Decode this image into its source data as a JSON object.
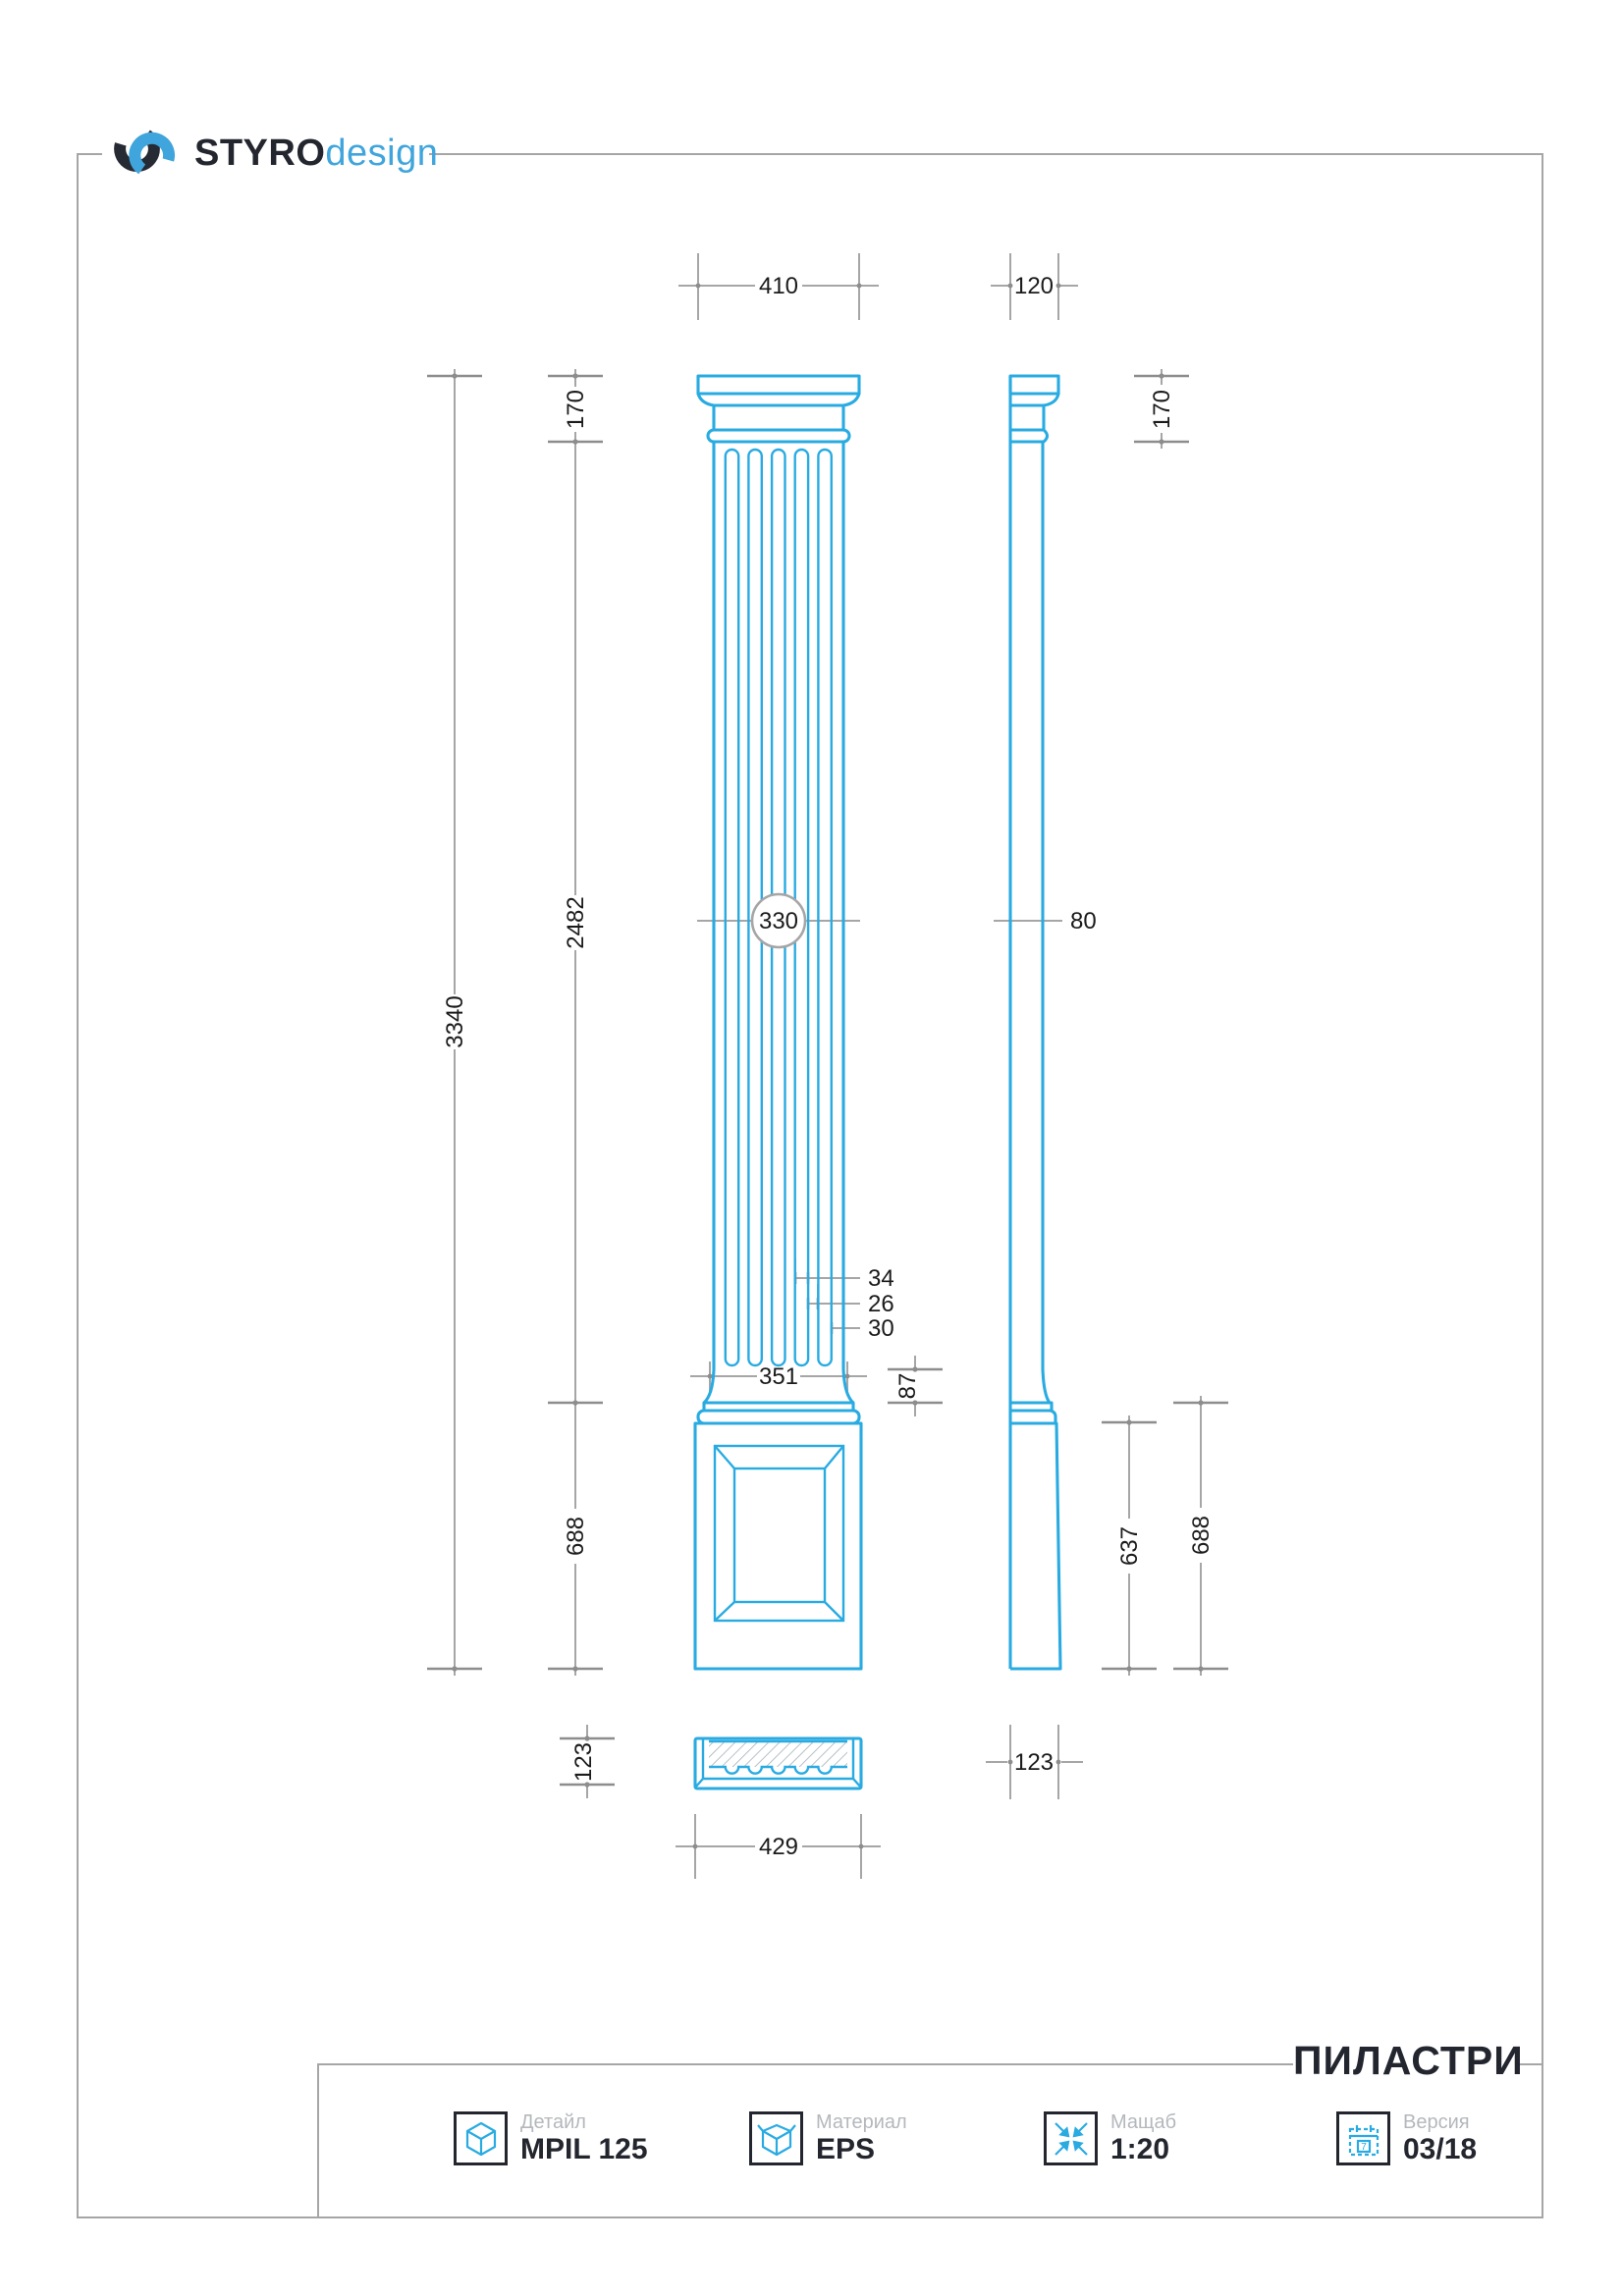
{
  "logo": {
    "brand_bold": "STYRO",
    "brand_light": "design"
  },
  "title_block": {
    "heading": "ПИЛАСТРИ",
    "items": [
      {
        "icon": "cube-icon",
        "label": "Детайл",
        "value": "MPIL 125"
      },
      {
        "icon": "open-box-icon",
        "label": "Материал",
        "value": "EPS"
      },
      {
        "icon": "scale-arrows-icon",
        "label": "Мащаб",
        "value": "1:20"
      },
      {
        "icon": "calendar-icon",
        "label": "Версия",
        "value": "03/18",
        "calendar_digit": "7"
      }
    ]
  },
  "dimensions": {
    "front": {
      "overall_width": "410",
      "capital_height": "170",
      "shaft_height": "2482",
      "total_height": "3340",
      "shaft_width": "330",
      "flute_width": "34",
      "flute_spacing": "26",
      "edge_fillet": "30",
      "shaft_bottom_width": "351",
      "apophyge_height": "87",
      "base_height": "688",
      "plinth_section_height": "123",
      "plinth_section_width": "429"
    },
    "side": {
      "overall_depth": "120",
      "capital_height": "170",
      "shaft_depth": "80",
      "pedestal_height": "637",
      "base_height": "688",
      "base_depth": "123"
    }
  },
  "colors": {
    "cyan": "#29abe2",
    "dim-gray": "#a6a6a6",
    "ink": "#23262e",
    "label-gray": "#b4b8bc",
    "logo-blue": "#3fa5dc"
  }
}
